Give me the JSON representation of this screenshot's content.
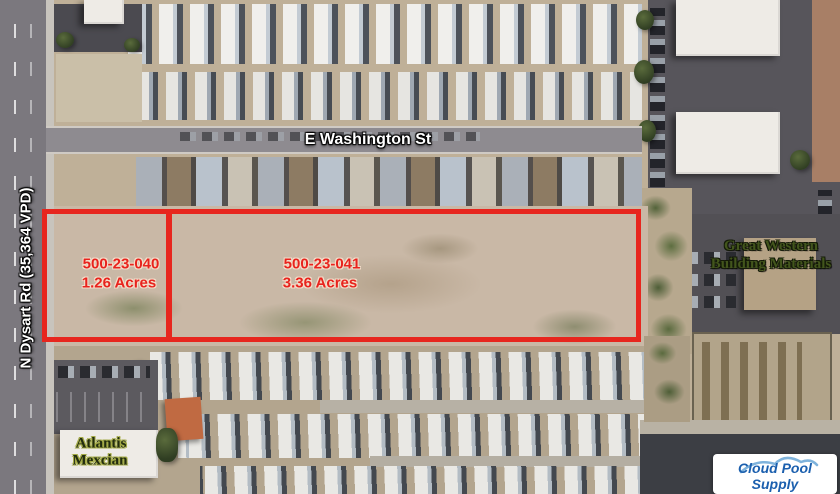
{
  "overlay": {
    "roads": {
      "dysart": "N Dysart Rd (35,364 VPD)",
      "washington": "E Washington St"
    },
    "parcels": [
      {
        "apn": "500-23-040",
        "acres": "1.26 Acres"
      },
      {
        "apn": "500-23-041",
        "acres": "3.36 Acres"
      }
    ],
    "businesses": {
      "great_western": {
        "line1": "Great Western",
        "line2": "Building Materials"
      },
      "atlantis": {
        "line1": "Atlantis",
        "line2": "Mexcian"
      },
      "cloud_pool": {
        "name": "Cloud Pool Supply"
      }
    },
    "colors": {
      "parcel_outline": "#e7261e",
      "parcel_text": "#e8231d",
      "road_text": "#ffffff",
      "green_business_text": "#42551c",
      "cloud_pool_text": "#1b5fae"
    }
  }
}
